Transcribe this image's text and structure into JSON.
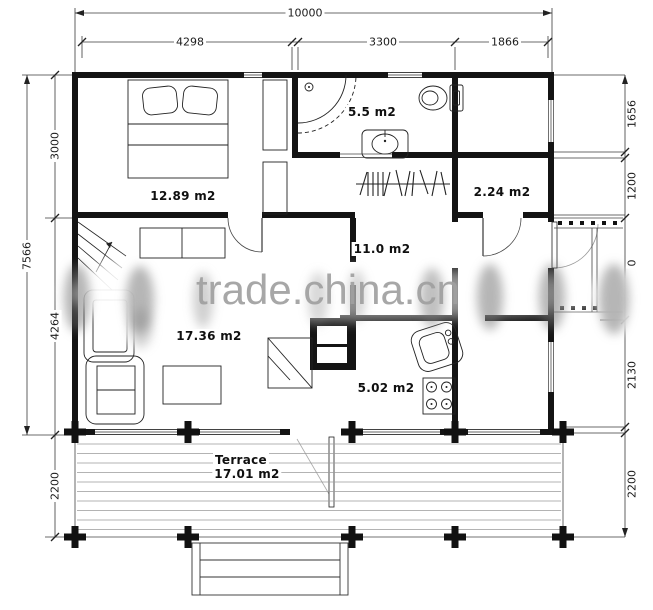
{
  "drawing": {
    "watermark": "trade.china.cn",
    "dimensions": {
      "top": {
        "overall": "10000",
        "segments": [
          "4298",
          "3300",
          "1866"
        ]
      },
      "left": {
        "overall": "7566",
        "segments": [
          "3000",
          "4264",
          "2200"
        ]
      },
      "right": {
        "segments": [
          "1656",
          "1200",
          "0",
          "2130",
          "2200"
        ]
      }
    },
    "rooms": {
      "bedroom": {
        "label": "12.89 m2"
      },
      "bathroom": {
        "label": "5.5 m2"
      },
      "closet": {
        "label": "2.24 m2"
      },
      "hall": {
        "label": "11.0 m2"
      },
      "living": {
        "label": "17.36 m2"
      },
      "kitchen": {
        "label": "5.02 m2"
      },
      "terrace": {
        "name": "Terrace",
        "label": "17.01 m2"
      }
    },
    "colors": {
      "wall": "#141414",
      "line": "#3a3a3a",
      "watermark_gray": "#a0a0a0"
    }
  }
}
